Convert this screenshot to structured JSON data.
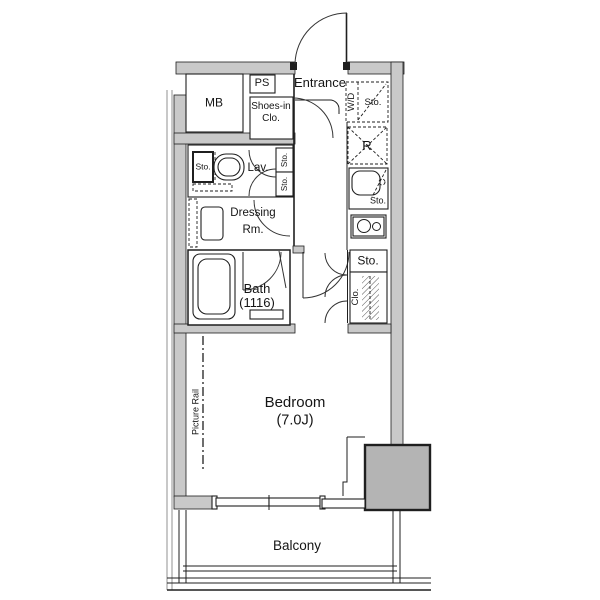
{
  "plan": {
    "title": "apartment-floor-plan",
    "labels": {
      "mb": "MB",
      "ps": "PS",
      "shoes_in_1": "Shoes-in",
      "shoes_in_2": "Clo.",
      "entrance": "Entrance",
      "washer_dryer": "W/D",
      "wd_storage": "Sto.",
      "refrigerator": "R",
      "lav_storage": "Sto.",
      "lavatory": "Lav.",
      "hall_storage_top": "Sto.",
      "hall_storage_bottom": "Sto.",
      "dressing_1": "Dressing",
      "dressing_2": "Rm.",
      "kitchen_storage": "Sto.",
      "bath": "Bath",
      "bath_size": "(1116)",
      "closet_storage": "Sto.",
      "closet": "Clo.",
      "bedroom": "Bedroom",
      "bedroom_size": "(7.0J)",
      "picture_rail": "Picture Rail",
      "balcony": "Balcony"
    },
    "colors": {
      "wall": "#c9c9c9",
      "pillar": "#b4b4b4",
      "line": "#1f1f1f",
      "bg": "#ffffff"
    }
  }
}
